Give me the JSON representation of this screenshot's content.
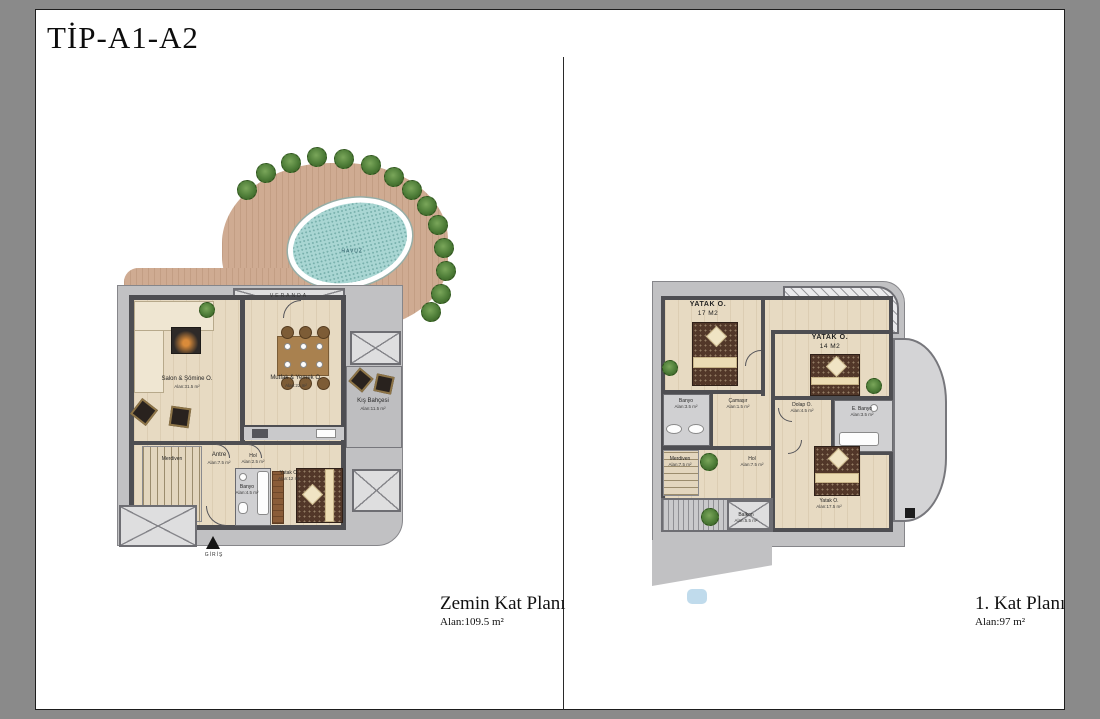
{
  "title": "TİP-A1-A2",
  "colors": {
    "frame_bg": "#8a8a8a",
    "pool": "#a9d6d3",
    "deck": "#cfab92",
    "floor": "#e7dac2",
    "terrace": "#c1c1c3",
    "wall": "#4e4e52",
    "tree": "#4e7d38"
  },
  "ground": {
    "caption": "Zemin Kat Planı",
    "total_area": "Alan:109.5 m²",
    "veranda": "VERANDA",
    "havuz": "HAVUZ",
    "giris": "GİRİŞ",
    "rooms": {
      "salon": {
        "name": "Salon & Şömine O.",
        "area": "Alan:31.5 m²"
      },
      "mutfak": {
        "name": "Mutfak & Yemek O.",
        "area": "Alan:22 m²"
      },
      "kis": {
        "name": "Kış Bahçesi",
        "area": "Alan:11.5 m²"
      },
      "antre": {
        "name": "Antre",
        "area": "Alan:7.5 m²"
      },
      "hol": {
        "name": "Hol",
        "area": "Alan:2.5 m²"
      },
      "banyo": {
        "name": "Banyo",
        "area": "Alan:4.5 m²"
      },
      "yatak": {
        "name": "Yatak O.",
        "area": "Alan:12 m²"
      },
      "merdiven": {
        "name": "Merdiven",
        "area": ""
      }
    }
  },
  "first": {
    "caption": "1. Kat Planı",
    "total_area": "Alan:97 m²",
    "rooms": {
      "yatak17": {
        "name": "YATAK O.",
        "area": "17 M2"
      },
      "yatak14": {
        "name": "YATAK O.",
        "area": "14 M2"
      },
      "banyo": {
        "name": "Banyo",
        "area": "Alan:3.5 m²"
      },
      "camasir": {
        "name": "Çamaşır",
        "area": "Alan:1.5 m²"
      },
      "dolap": {
        "name": "Dolap O.",
        "area": "Alan:4.5 m²"
      },
      "ebanyo": {
        "name": "E. Banyo",
        "area": "Alan:3.5 m²"
      },
      "merdiven": {
        "name": "Merdiven",
        "area": "Alan:7.5 m²"
      },
      "hol": {
        "name": "Hol",
        "area": "Alan:7.5 m²"
      },
      "yatak3": {
        "name": "Yatak O.",
        "area": "Alan:17.5 m²"
      },
      "balkon": {
        "name": "Balkon",
        "area": "Alan:5.5 m²"
      }
    }
  }
}
